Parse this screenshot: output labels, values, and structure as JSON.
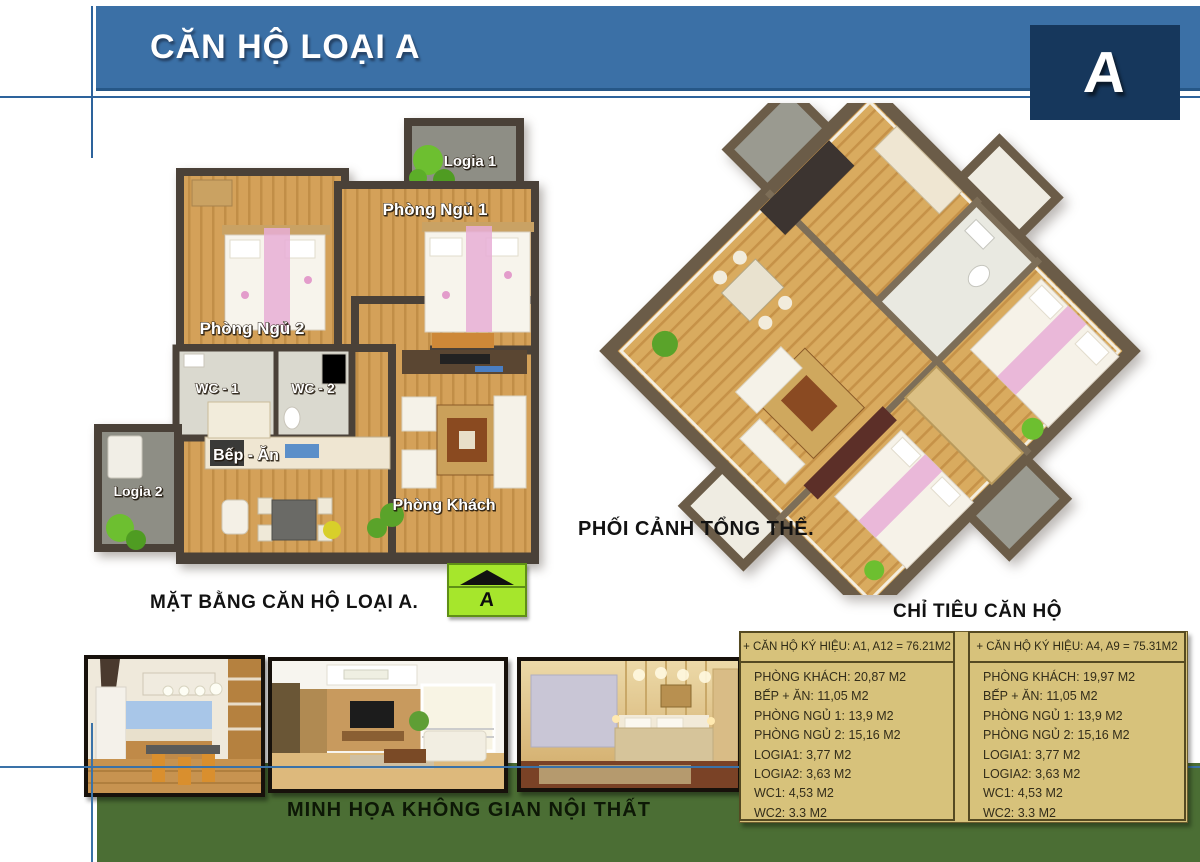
{
  "header": {
    "title": "CĂN HỘ LOẠI A",
    "corner_letter": "A"
  },
  "floor_plan": {
    "caption": "MẶT BẰNG CĂN HỘ LOẠI A.",
    "compass_letter": "A",
    "rooms": {
      "logia1": "Logia 1",
      "bedroom1": "Phòng Ngủ 1",
      "bedroom2": "Phòng Ngủ 2",
      "wc1": "WC - 1",
      "wc2": "WC - 2",
      "logia2": "Logia 2",
      "kitchen": "Bếp - Ăn",
      "living": "Phòng Khách"
    }
  },
  "perspective": {
    "caption": "PHỐI CẢNH TỔNG THỂ."
  },
  "specs": {
    "heading": "CHỈ TIÊU CĂN HỘ",
    "tables": [
      {
        "header": "+ CĂN HỘ KÝ HIỆU: A1, A12 = 76.21M2",
        "rows": [
          "PHÒNG KHÁCH: 20,87 M2",
          "BẾP + ĂN: 11,05 M2",
          "PHÒNG NGỦ 1: 13,9 M2",
          "PHÒNG NGỦ 2: 15,16 M2",
          "LOGIA1: 3,77 M2",
          "LOGIA2: 3,63 M2",
          "WC1: 4,53 M2",
          "WC2: 3.3 M2"
        ]
      },
      {
        "header": "+ CĂN HỘ KÝ HIỆU: A4, A9 = 75.31M2",
        "rows": [
          "PHÒNG KHÁCH: 19,97 M2",
          "BẾP + ĂN: 11,05 M2",
          "PHÒNG NGỦ 1: 13,9 M2",
          "PHÒNG NGỦ 2: 15,16 M2",
          "LOGIA1: 3,77 M2",
          "LOGIA2: 3,63 M2",
          "WC1: 4,53 M2",
          "WC2: 3.3 M2"
        ]
      }
    ]
  },
  "gallery": {
    "caption": "MINH HỌA KHÔNG GIAN NỘI THẤT",
    "photos": [
      "kitchen and dining interior",
      "living room interior",
      "bedroom interior"
    ]
  },
  "colors": {
    "header_blue": "#3b70a6",
    "corner_navy": "#16375c",
    "rule_blue": "#2d639c",
    "green_band": "#4b6e34",
    "table_tan": "#d7c27b",
    "table_border": "#554a22",
    "compass_green": "#a6e62c",
    "wall_brown": "#4a4138",
    "wood_floor": "#d4a159"
  }
}
